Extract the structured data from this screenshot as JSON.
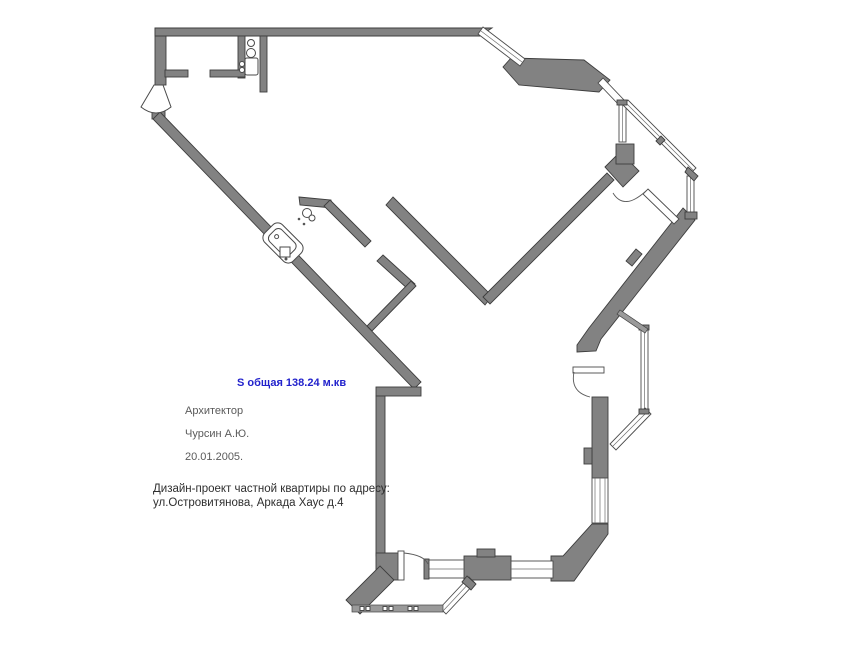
{
  "plan": {
    "area_label": "S общая 138.24 м.кв",
    "architect_label": "Архитектор",
    "architect_name": "Чурсин А.Ю.",
    "date": "20.01.2005.",
    "project_line1": "Дизайн-проект частной квартиры по адресу:",
    "project_line2": "ул.Островитянова, Аркада Хаус д.4"
  },
  "colors": {
    "area_label_blue": "#2222cc",
    "wall_fill": "#828282",
    "wall_stroke": "#3d3d3d",
    "note_gray": "#5a5a5a",
    "note_dark": "#2e2e2e",
    "background": "#ffffff"
  }
}
